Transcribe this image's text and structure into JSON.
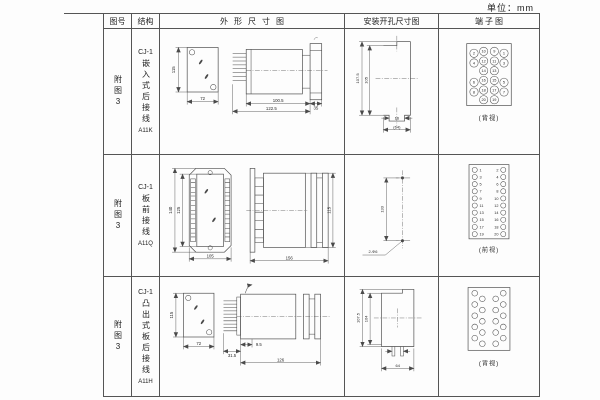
{
  "unit_label": "单位：mm",
  "header": {
    "fig_no": "图号",
    "structure": "结构",
    "outline": "外形尺寸图",
    "install": "安装开孔尺寸图",
    "terminal": "端子图"
  },
  "rows": [
    {
      "fig_no": "附图3",
      "model": "CJ-1",
      "structure": "嵌入式后接线",
      "code": "A11K",
      "outline": {
        "front_h": "115",
        "front_w": "72",
        "side_d1": "100.5",
        "side_d2": "122.5",
        "side_d3": "35"
      },
      "install": {
        "v_outer": "107.5",
        "v_inner": "105",
        "slot_w": "16",
        "h_bottom": "(64)"
      },
      "terminal": {
        "view_label": "(背视)",
        "numbers": [
          "2",
          "10",
          "9",
          "1",
          "4",
          "12",
          "11",
          "3",
          "14",
          "13",
          "6",
          "16",
          "15",
          "5",
          "8",
          "18",
          "17",
          "7",
          "20",
          "19"
        ]
      }
    },
    {
      "fig_no": "附图3",
      "model": "CJ-1",
      "structure": "板前接线",
      "code": "A11Q",
      "outline": {
        "front_h_outer": "140",
        "front_h_inner": "125",
        "front_w": "105",
        "side_w": "156",
        "side_h": "115"
      },
      "install": {
        "hole_pitch": "133",
        "hole_label": "2-Φ6"
      },
      "terminal": {
        "view_label": "(前视)",
        "left": [
          "1",
          "3",
          "5",
          "7",
          "9",
          "11",
          "13",
          "15",
          "17",
          "19"
        ],
        "right": [
          "2",
          "4",
          "6",
          "8",
          "10",
          "12",
          "14",
          "16",
          "18",
          "20"
        ]
      }
    },
    {
      "fig_no": "附图3",
      "model": "CJ-1",
      "structure": "凸出式板后接线",
      "code": "A11H",
      "outline": {
        "front_h": "115",
        "front_w": "72",
        "side_d1": "31.5",
        "side_d2": "9.5",
        "side_d3": "126"
      },
      "install": {
        "v_outer": "107.5",
        "v_inner": "104",
        "h_bottom": "64"
      },
      "terminal": {
        "view_label": "(背视)"
      }
    }
  ]
}
